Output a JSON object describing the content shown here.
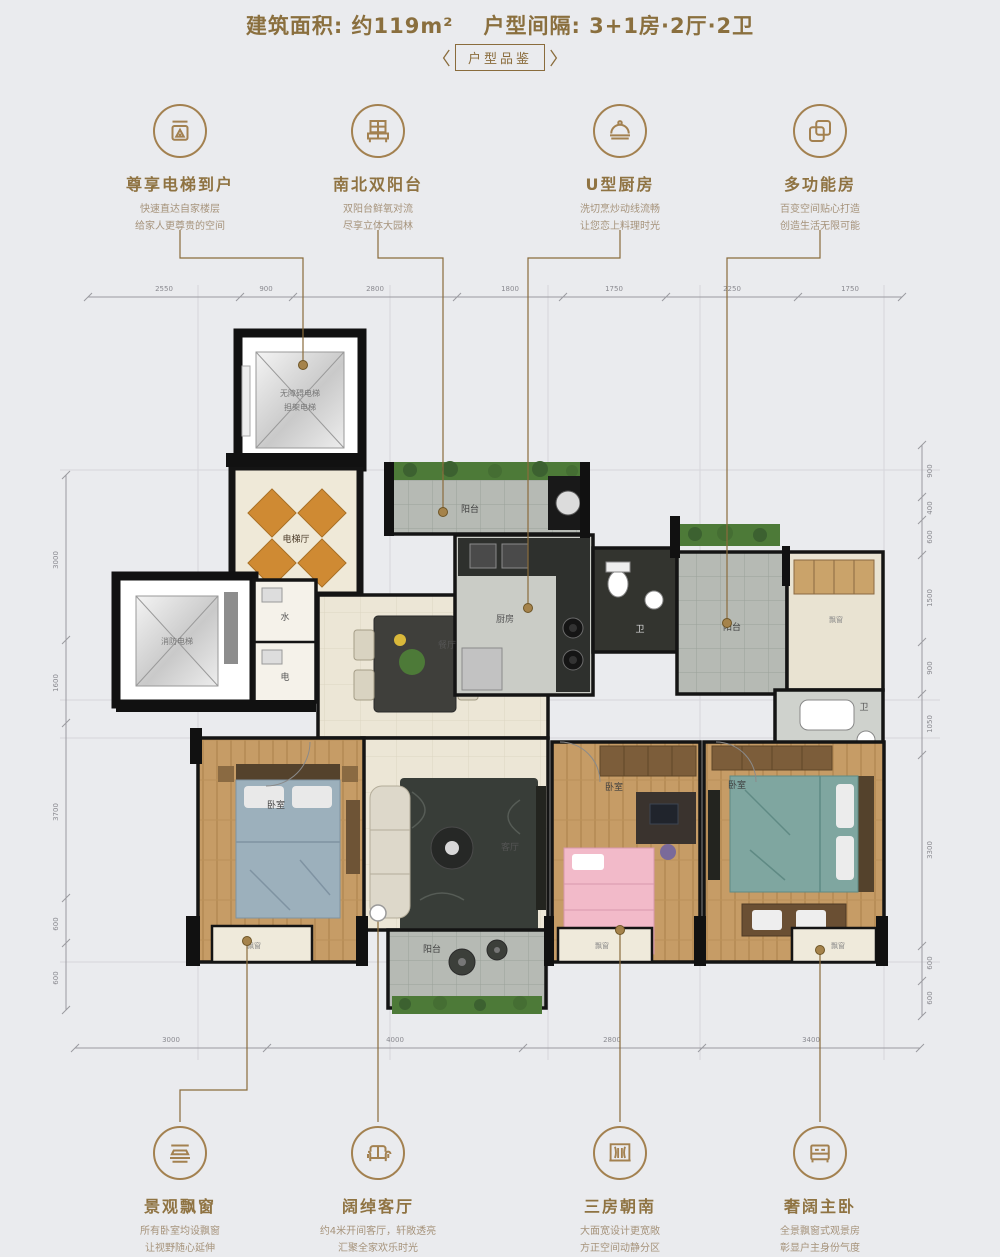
{
  "header": {
    "title_left": "建筑面积: 约119m²",
    "title_right": "户型间隔: 3+1房·2厅·2卫",
    "badge": "户型品鉴"
  },
  "features_top": [
    {
      "icon": "elevator-icon",
      "label": "尊享电梯到户",
      "desc1": "快速直达自家楼层",
      "desc2": "给家人更尊贵的空间"
    },
    {
      "icon": "double-balcony-icon",
      "label": "南北双阳台",
      "desc1": "双阳台鲜氧对流",
      "desc2": "尽享立体大园林"
    },
    {
      "icon": "kitchen-cloche-icon",
      "label": "U型厨房",
      "desc1": "洗切烹炒动线流畅",
      "desc2": "让您恋上料理时光"
    },
    {
      "icon": "multi-room-icon",
      "label": "多功能房",
      "desc1": "百变空间贴心打造",
      "desc2": "创造生活无限可能"
    }
  ],
  "features_bottom": [
    {
      "icon": "bay-window-icon",
      "label": "景观飘窗",
      "desc1": "所有卧室均设飘窗",
      "desc2": "让视野随心延伸"
    },
    {
      "icon": "sofa-icon",
      "label": "阔绰客厅",
      "desc1": "约4米开间客厅，轩敞透亮",
      "desc2": "汇聚全家欢乐时光"
    },
    {
      "icon": "south-rooms-icon",
      "label": "三房朝南",
      "desc1": "大面宽设计更宽敞",
      "desc2": "方正空间动静分区"
    },
    {
      "icon": "master-bed-icon",
      "label": "奢阔主卧",
      "desc1": "全景飘窗式观景房",
      "desc2": "彰显户主身份气度"
    }
  ],
  "plan": {
    "labels": {
      "lift1_line1": "无障碍电梯",
      "lift1_line2": "担架电梯",
      "lift_hall": "电梯厅",
      "fire_lift": "消防电梯",
      "water": "水",
      "power": "电",
      "balcony_north": "阳台",
      "kitchen": "厨房",
      "bath_a": "卫",
      "balcony_east": "阳台",
      "bay_right": "飘窗",
      "dining": "餐厅",
      "living": "客厅",
      "bedroom_left": "卧室",
      "bedroom_mid": "卧室",
      "bedroom_master": "卧室",
      "bath_master": "卫",
      "balcony_south": "阳台",
      "bay_left": "飘窗",
      "bay_mid": "飘窗",
      "bay_master": "飘窗"
    },
    "dims_top": [
      "2550",
      "900",
      "2800",
      "1800",
      "1750",
      "2250",
      "1750"
    ],
    "dims_bottom": [
      "3000",
      "4000",
      "2800",
      "3400"
    ],
    "dims_left": [
      "3000",
      "1600",
      "3700",
      "600",
      "600"
    ],
    "dims_right": [
      "900",
      "400",
      "600",
      "1500",
      "900",
      "1050",
      "3300",
      "600",
      "600"
    ]
  },
  "colors": {
    "accent": "#8a6c3c",
    "background": "#eaebee",
    "wall": "#141414",
    "wood_floor": "#c69c66",
    "grey_tile": "#b6bab4",
    "cream_tile": "#ece6d6",
    "plant_green": "#4d7a38",
    "hall_orange": "#cf8a33"
  }
}
